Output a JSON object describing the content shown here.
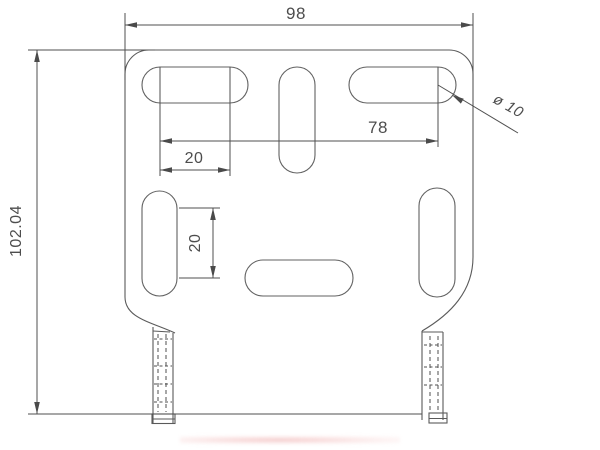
{
  "drawing": {
    "type": "technical-dimension-drawing",
    "part": "slotted mounting plate with two bottom tabs",
    "labels": {
      "overall_width": "98",
      "overall_height": "102.04",
      "hole_span": "78",
      "top_slot_spacing": "20",
      "side_slot_spacing": "20",
      "hole_diameter": "ø 10"
    },
    "colors": {
      "background": "#ffffff",
      "geometry_line": "#5a5a5a",
      "dimension_line": "#4f4f4f",
      "text": "#4d4d4d",
      "render_artifact_pink": "#eca0a0"
    }
  }
}
